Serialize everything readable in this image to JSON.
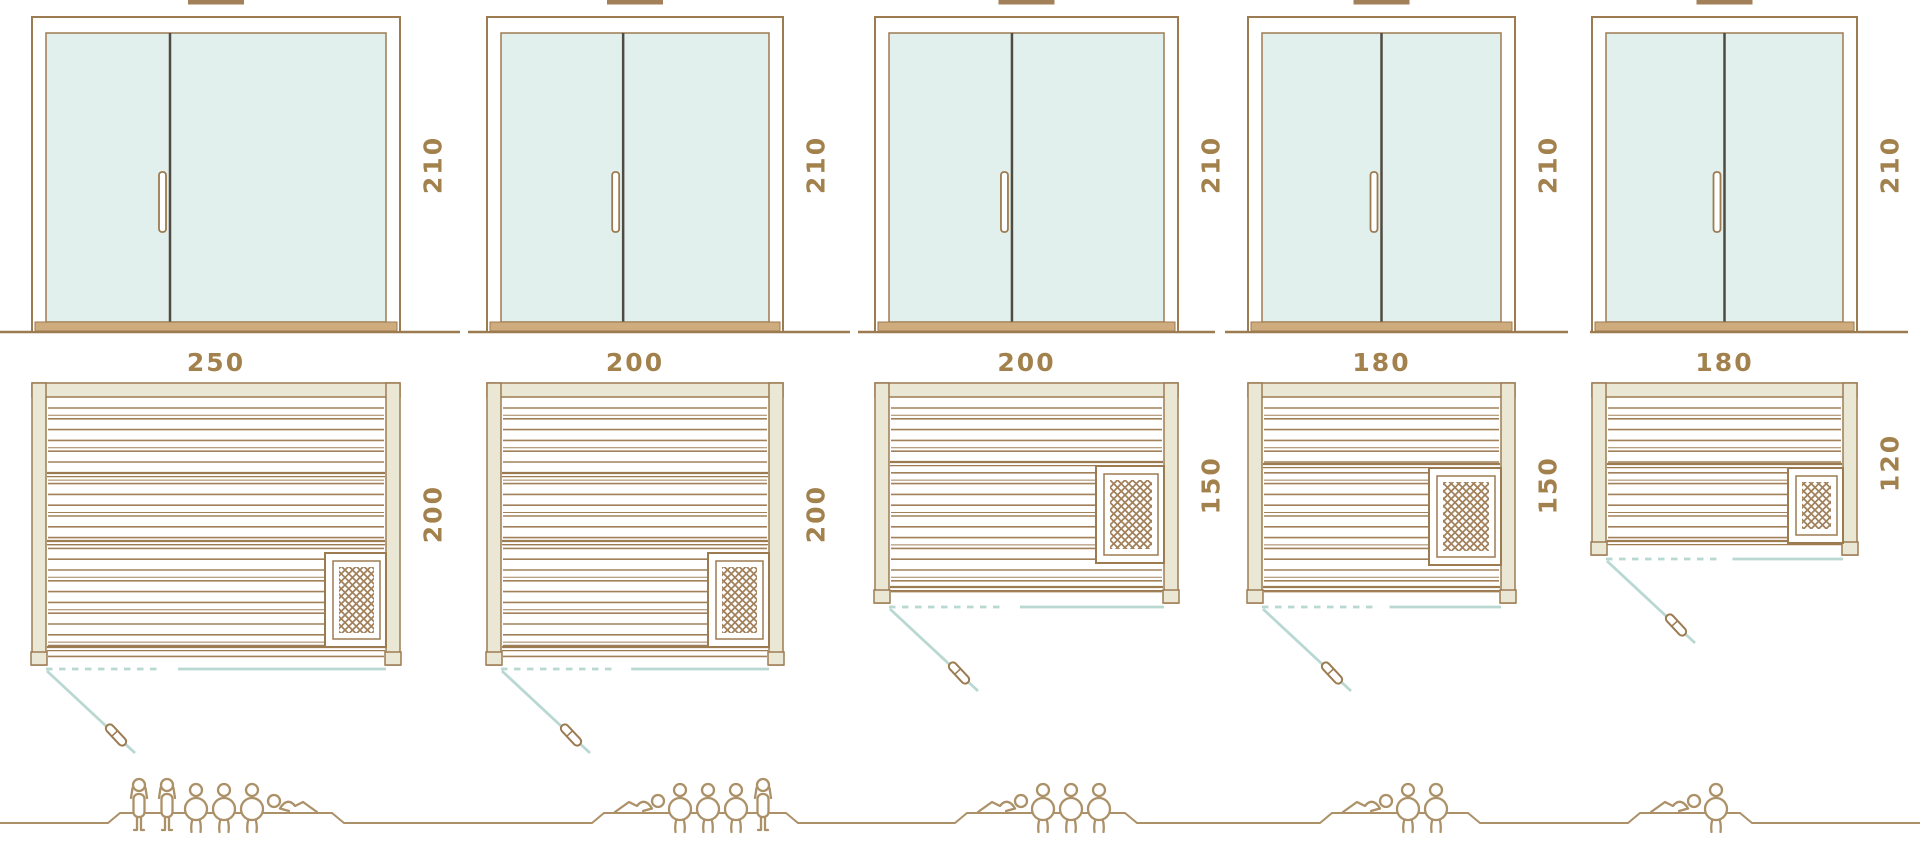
{
  "diagram": {
    "name": "sauna-size-comparison-diagram",
    "colors": {
      "frame_brown": "#9c7b51",
      "plank_brown": "#a1805a",
      "label_brown": "#a2814d",
      "glass_fill": "#e2f0ed",
      "wall_fill": "#eae7d4",
      "sill_tan": "#cfac7e",
      "divider_dark": "#4f4b43",
      "swing_blue": "#b9d8d2",
      "people_tan": "#ac9168"
    },
    "units": [
      {
        "name": "sauna-250x200",
        "width_label": "250",
        "depth_label": "200",
        "height_label": "210",
        "capacity": {
          "standing": 2,
          "sitting": 3,
          "lying": 1,
          "total": 6
        }
      },
      {
        "name": "sauna-200x200",
        "width_label": "200",
        "depth_label": "200",
        "height_label": "210",
        "capacity": {
          "standing": 1,
          "sitting": 3,
          "lying": 1,
          "total": 5
        }
      },
      {
        "name": "sauna-200x150",
        "width_label": "200",
        "depth_label": "150",
        "height_label": "210",
        "capacity": {
          "standing": 0,
          "sitting": 3,
          "lying": 1,
          "total": 4
        }
      },
      {
        "name": "sauna-180x150",
        "width_label": "180",
        "depth_label": "150",
        "height_label": "210",
        "capacity": {
          "standing": 0,
          "sitting": 2,
          "lying": 1,
          "total": 3
        }
      },
      {
        "name": "sauna-180x120",
        "width_label": "180",
        "depth_label": "120",
        "height_label": "210",
        "capacity": {
          "standing": 0,
          "sitting": 1,
          "lying": 1,
          "total": 2
        }
      }
    ]
  }
}
